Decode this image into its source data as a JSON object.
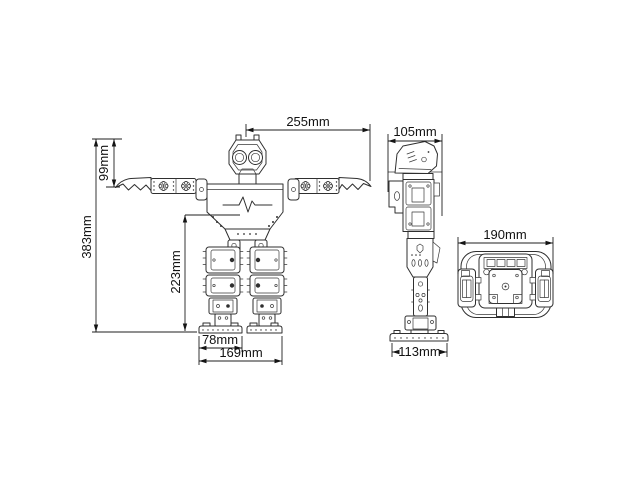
{
  "document": {
    "background_color": "#ffffff",
    "line_color": "#2f2f2f",
    "text_color": "#121212",
    "unit": "mm"
  },
  "dimensions": {
    "arm_span": {
      "label": "255mm",
      "value": 255
    },
    "head_to_arm_height": {
      "label": "99mm",
      "value": 99
    },
    "overall_height": {
      "label": "383mm",
      "value": 383
    },
    "leg_height": {
      "label": "223mm",
      "value": 223
    },
    "foot_width": {
      "label": "78mm",
      "value": 78
    },
    "stance_width": {
      "label": "169mm",
      "value": 169
    },
    "side_depth": {
      "label": "105mm",
      "value": 105
    },
    "foot_length": {
      "label": "113mm",
      "value": 113
    },
    "shoulder_width": {
      "label": "190mm",
      "value": 190
    }
  }
}
